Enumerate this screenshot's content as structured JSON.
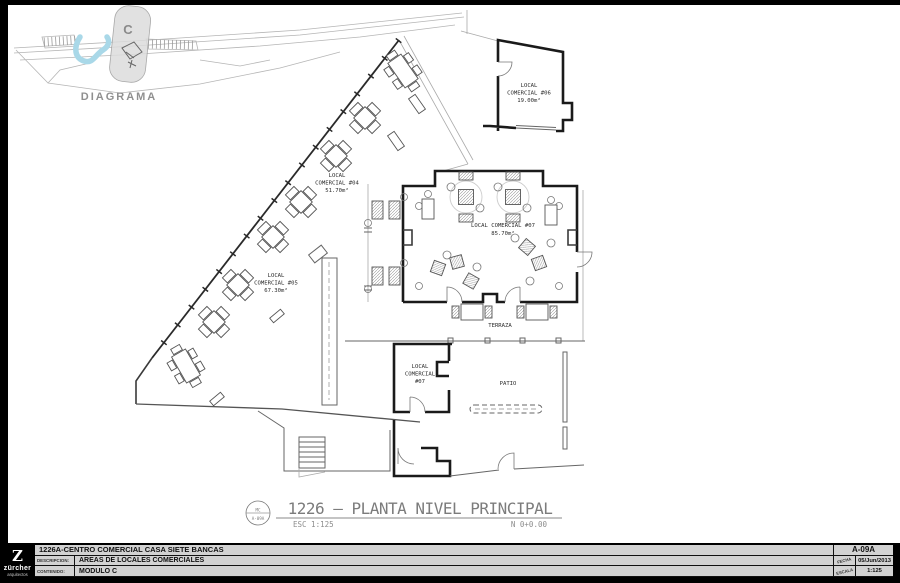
{
  "colors": {
    "river": "#a9d8e8",
    "paper": "#ffffff",
    "frame": "#000000",
    "titleblock_bg": "#d2d2d2"
  },
  "diagram": {
    "label": "DIAGRAMA",
    "module_letter": "C"
  },
  "plan": {
    "title": "1226 — PLANTA NIVEL PRINCIPAL",
    "scale_note": "ESC 1:125",
    "level_note": "N 0+0.00",
    "ref_bubble": {
      "top": "MC",
      "bottom": "A-09A"
    },
    "areas": {
      "terraza": "TERRAZA",
      "patio": "PATIO"
    },
    "locals": [
      {
        "name": "local-comercial-04",
        "line1": "LOCAL",
        "line2": "COMERCIAL #04",
        "area": "51.70m²"
      },
      {
        "name": "local-comercial-05",
        "line1": "LOCAL",
        "line2": "COMERCIAL #05",
        "area": "67.30m²"
      },
      {
        "name": "local-comercial-06",
        "line1": "LOCAL",
        "line2": "COMERCIAL #06",
        "area": "19.00m²"
      },
      {
        "name": "local-comercial-07",
        "line1": "LOCAL COMERCIAL #07",
        "area": "85.70m²"
      },
      {
        "name": "local-comercial-07-service",
        "line1": "LOCAL",
        "line2": "COMERCIAL",
        "line3": "#07"
      }
    ]
  },
  "titleblock": {
    "project": "1226A-CENTRO COMERCIAL CASA SIETE BANCAS",
    "descripcion_label": "DESCRIPCION:",
    "descripcion": "AREAS DE LOCALES COMERCIALES",
    "contenido_label": "CONTENIDO:",
    "contenido": "MODULO C",
    "sheet": "A-09A",
    "fecha_label": "FECHA",
    "fecha": "05/Jun/2013",
    "escala_label": "ESCALA",
    "escala": "1:125",
    "logo": {
      "mark": "Z",
      "name": "zürcher",
      "sub": "arquitectos"
    }
  }
}
